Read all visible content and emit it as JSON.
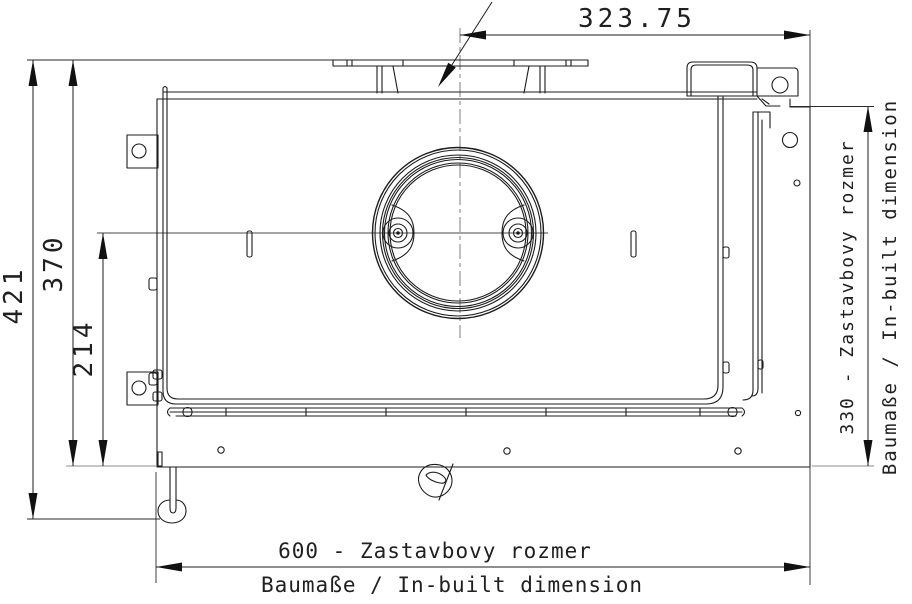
{
  "drawing": {
    "kind": "CAD technical drawing - fireplace insert, top view",
    "dimensions": {
      "top_width": "323.75",
      "total_height": "421",
      "body_height": "370",
      "center_height": "214",
      "right_depth_line1": "330 - Zastavbovy rozmer",
      "right_depth_line2": "Baumaße / In-built dimension",
      "bottom_width_line1": "600 - Zastavbovy rozmer",
      "bottom_width_line2": "Baumaße / In-built dimension"
    },
    "colors": {
      "line": "#1c1c1c",
      "centerline": "#7c7c7c",
      "extension_gray": "#8d8d8d",
      "background": "#ffffff"
    }
  }
}
